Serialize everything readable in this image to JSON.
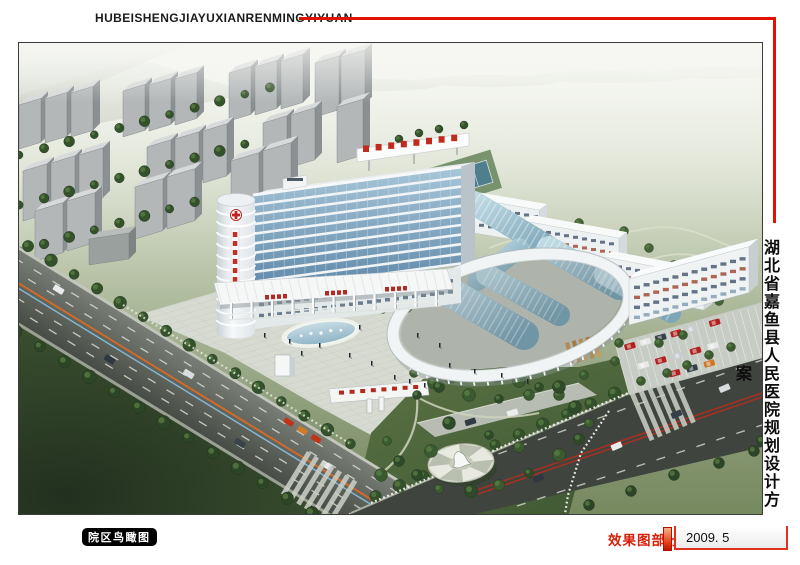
{
  "header": {
    "title_latin": "HUBEISHENGJIAYUXIANRENMINGYIYUAN"
  },
  "side_title": {
    "text": "湖北省嘉鱼县人民医院规划设计方案"
  },
  "footer": {
    "caption": "院区鸟瞰图",
    "section_label": "效果图部分",
    "date": "2009. 5"
  },
  "colors": {
    "accent_red": "#e11300",
    "label_red": "#d8200b",
    "badge_bg": "#000000",
    "badge_fg": "#ffffff"
  }
}
